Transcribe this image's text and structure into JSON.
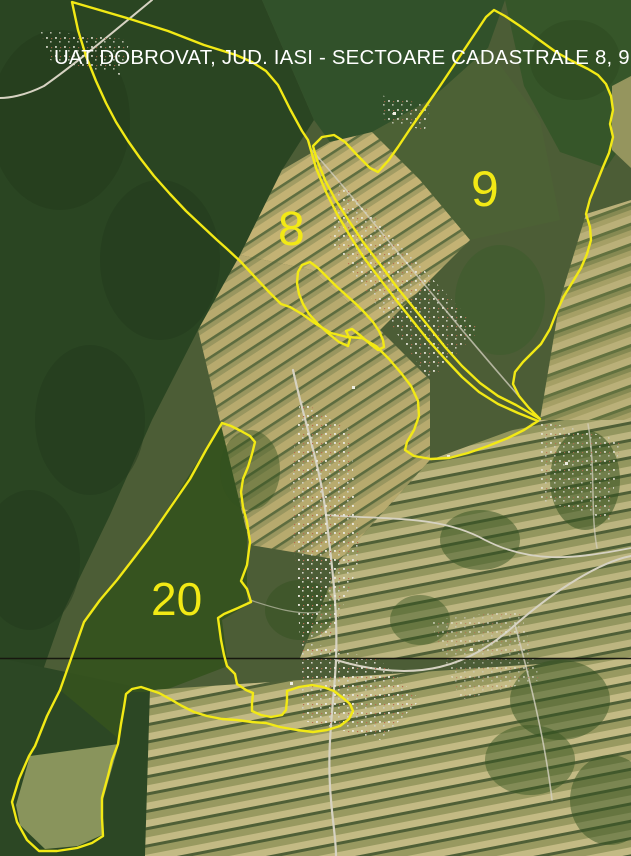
{
  "title": "UAT DOBROVAT, JUD. IASI - SECTOARE CADASTRALE 8, 9, 20",
  "colors": {
    "boundary": "#f2e915",
    "sector_label": "#f2e915",
    "title_text": "#ffffff",
    "divider_line": "#17170f"
  },
  "sectors": [
    {
      "label": "8",
      "outline": "72,2 96,9 130,19 168,31 204,45 236,55 252,62 266,71 278,85 290,109 302,131 308,140 316,168 326,192 337,214 350,236 364,258 380,279 396,300 412,320 428,340 446,360 462,377 479,392 498,404 518,413 538,421 524,430 508,438 488,446 468,453 449,458 431,459 414,456 405,450 407,442 414,430 419,416 418,401 411,386 401,373 389,359 376,346 362,338 347,337 331,333 316,324 302,314 290,307 281,304 269,292 254,276 240,261 226,248 217,240 202,226 186,211 170,194 154,176 140,158 128,141 116,122 106,103 96,81 86,56 78,30"
    },
    {
      "label": "9",
      "outline": "313,146 322,137 334,135 345,142 358,156 370,168 378,172 388,161 398,147 410,129 424,109 440,86 456,62 472,38 486,17 494,10 505,16 520,26 538,39 556,52 572,61 588,69 598,75 606,84 611,96 613,110 610,124 613,137 609,153 603,167 597,182 590,199 586,214 590,227 591,240 587,254 581,268 572,283 564,296 557,311 550,329 541,344 532,353 523,362 515,372 513,384 519,396 529,408 540,419 528,412 516,405 498,396 480,383 462,366 445,347 429,327 413,307 396,286 379,263 363,242 349,221 335,199 325,180 317,160"
    },
    {
      "label": "20",
      "outline": "222,423 231,426 241,431 250,436 255,442 252,454 248,467 243,479 241,492 243,507 247,522 250,542 247,565 241,581 247,589 251,602 238,608 224,614 218,618 221,640 224,655 227,666 235,674 237,684 246,690 253,693 252,703 252,711 261,715 271,717 282,715 286,710 287,700 287,691 299,687 312,685 323,687 334,691 343,698 350,704 353,711 349,719 340,726 327,730 313,732 297,730 280,727 266,723 252,722 237,720 222,719 207,716 194,712 182,706 170,699 159,693 150,690 141,687 132,689 126,694 124,707 121,724 118,744 112,760 108,776 102,798 102,818 103,836 92,843 77,848 57,851 39,851 27,840 17,822 12,802 19,779 29,756 35,746 47,716 60,690 72,656 84,622 100,600 117,580 134,558 150,537 170,508 190,479 206,450"
    }
  ],
  "enclave": {
    "outline": "310,262 318,268 326,276 336,286 346,295 356,304 365,313 373,322 379,331 383,340 384,347 378,350 370,344 361,336 352,329 346,331 350,339 348,346 339,342 329,334 318,324 309,314 303,304 299,294 297,283 298,272 302,265"
  }
}
